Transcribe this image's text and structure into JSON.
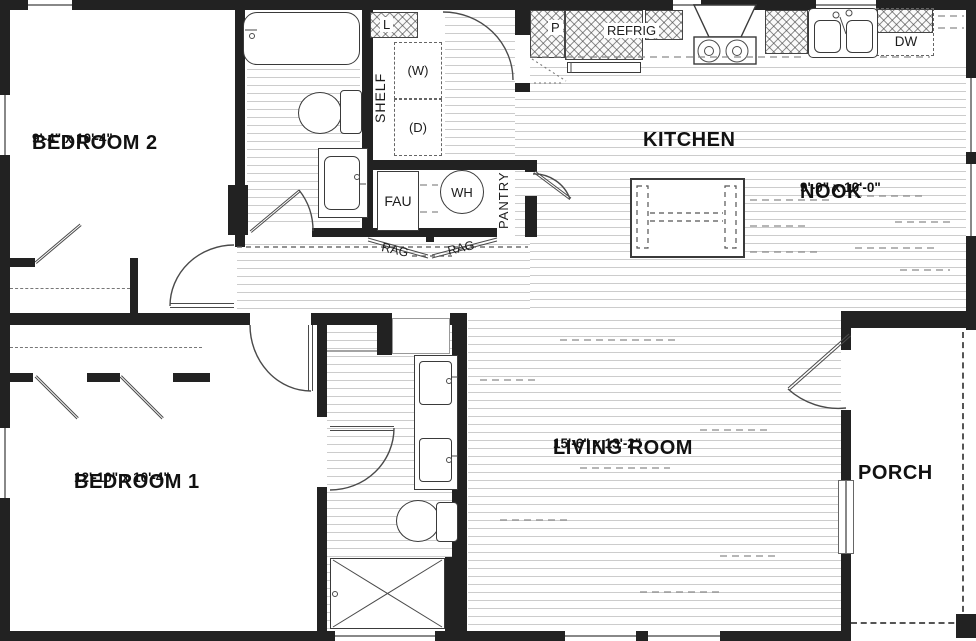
{
  "rooms": {
    "bedroom2": {
      "name": "BEDROOM 2",
      "dims": "9'-4\" x 10'-4\""
    },
    "bedroom1": {
      "name": "BEDROOM 1",
      "dims": "12'-10\" x 10'-4\""
    },
    "kitchen": {
      "name": "KITCHEN"
    },
    "nook": {
      "name": "NOOK",
      "dims": "9'-0\" x 10'-0\""
    },
    "living": {
      "name": "LIVING ROOM",
      "dims": "15'-6\" x 13'-2\""
    },
    "porch": {
      "name": "PORCH"
    }
  },
  "labels": {
    "linen": "L",
    "shelf": "SHELF",
    "washer": "(W)",
    "dryer": "(D)",
    "fau": "FAU",
    "water_heater": "WH",
    "pantry": "PANTRY",
    "rag_left": "RAG",
    "rag_right": "RAG",
    "pantry_cabinet": "P",
    "refrigerator": "REFRIG",
    "dishwasher": "DW"
  },
  "colors": {
    "wall": "#222222",
    "line": "#4a4a4a",
    "floor_line": "#cccccc"
  }
}
